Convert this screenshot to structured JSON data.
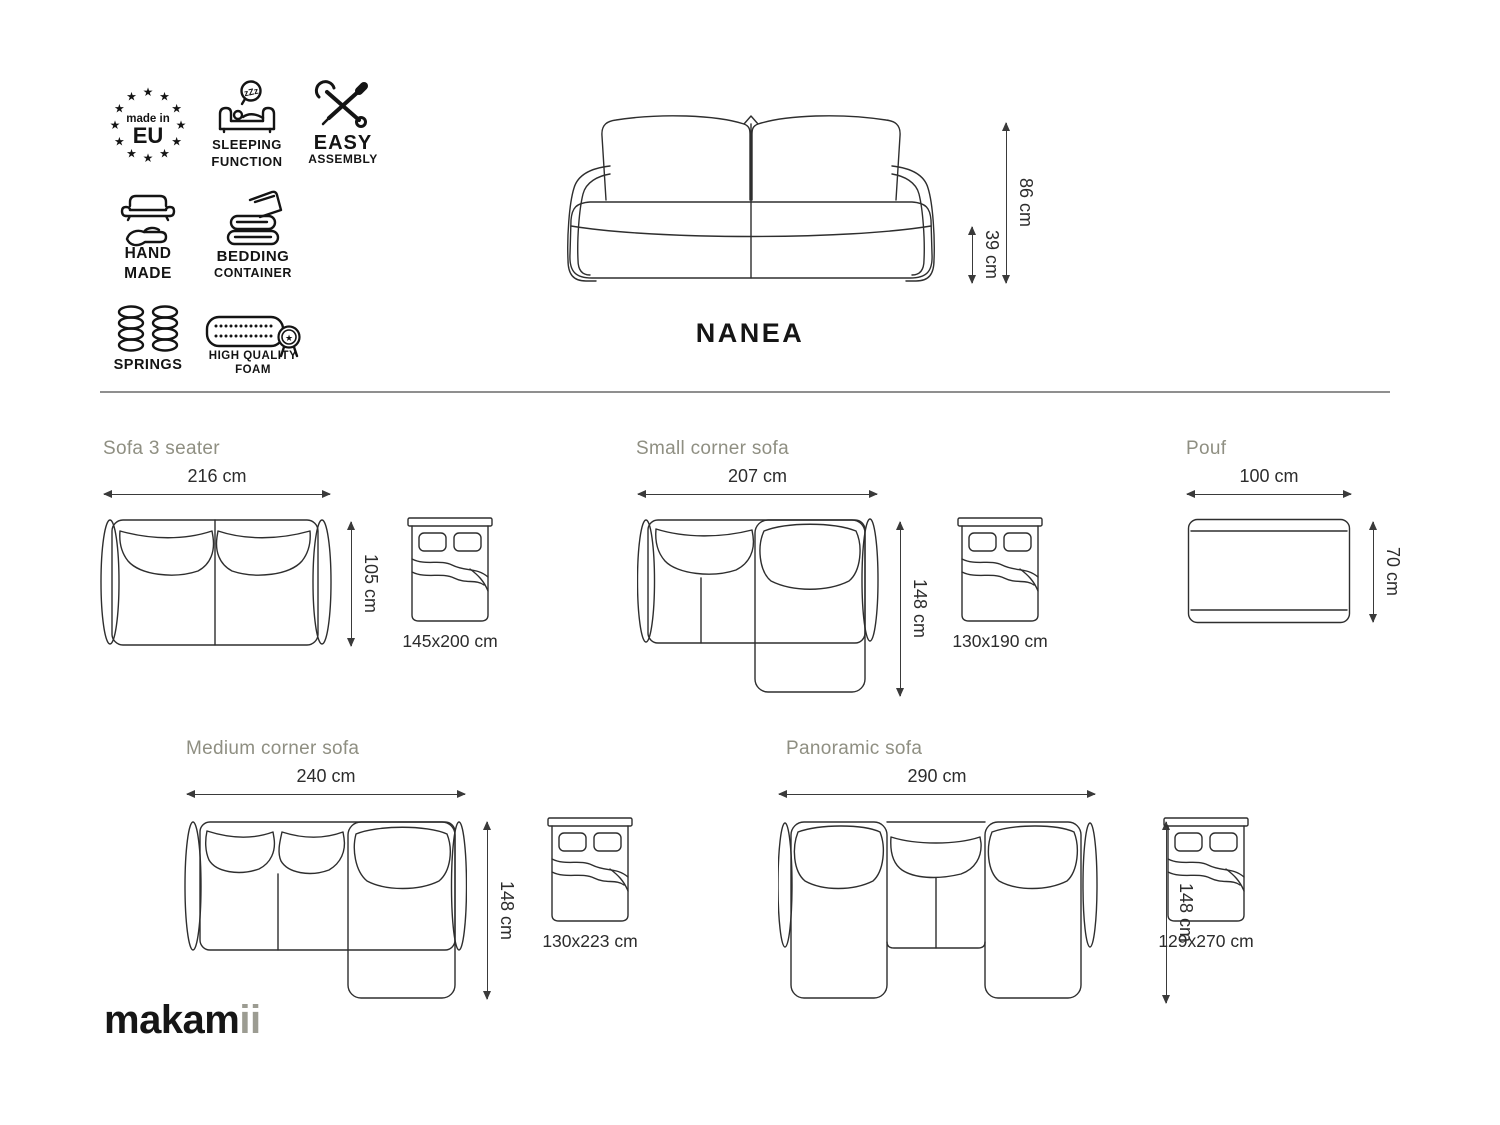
{
  "product": {
    "name": "NANEA"
  },
  "brand": {
    "black": "makam",
    "gray": "ii"
  },
  "badges": {
    "made_in_eu": {
      "small": "made in",
      "big": "EU"
    },
    "sleeping_function": {
      "line1": "SLEEPING",
      "line2": "FUNCTION",
      "bubble": "zZz"
    },
    "easy_assembly": {
      "line1": "EASY",
      "line2": "ASSEMBLY"
    },
    "hand_made": {
      "line1": "HAND",
      "line2": "MADE"
    },
    "bedding_container": {
      "line1": "BEDDING",
      "line2": "CONTAINER"
    },
    "springs": {
      "line1": "SPRINGS"
    },
    "high_quality_foam": {
      "line1": "HIGH QUALITY",
      "line2": "FOAM"
    }
  },
  "front_view": {
    "total_height": "86 cm",
    "seat_height": "39 cm"
  },
  "variants": {
    "sofa_3_seater": {
      "title": "Sofa 3 seater",
      "width": "216 cm",
      "depth": "105 cm",
      "bed": "145x200 cm"
    },
    "small_corner": {
      "title": "Small corner sofa",
      "width": "207 cm",
      "depth": "148 cm",
      "bed": "130x190 cm"
    },
    "pouf": {
      "title": "Pouf",
      "width": "100 cm",
      "depth": "70 cm"
    },
    "medium_corner": {
      "title": "Medium corner sofa",
      "width": "240 cm",
      "depth": "148 cm",
      "bed": "130x223 cm"
    },
    "panoramic": {
      "title": "Panoramic sofa",
      "width": "290 cm",
      "depth": "148 cm",
      "bed": "129x270 cm"
    }
  },
  "colors": {
    "ink": "#141414",
    "line": "#2e2e2e",
    "heading": "#8f8f82",
    "divider": "#8f8f8f",
    "brand_gray": "#9c9c92"
  }
}
